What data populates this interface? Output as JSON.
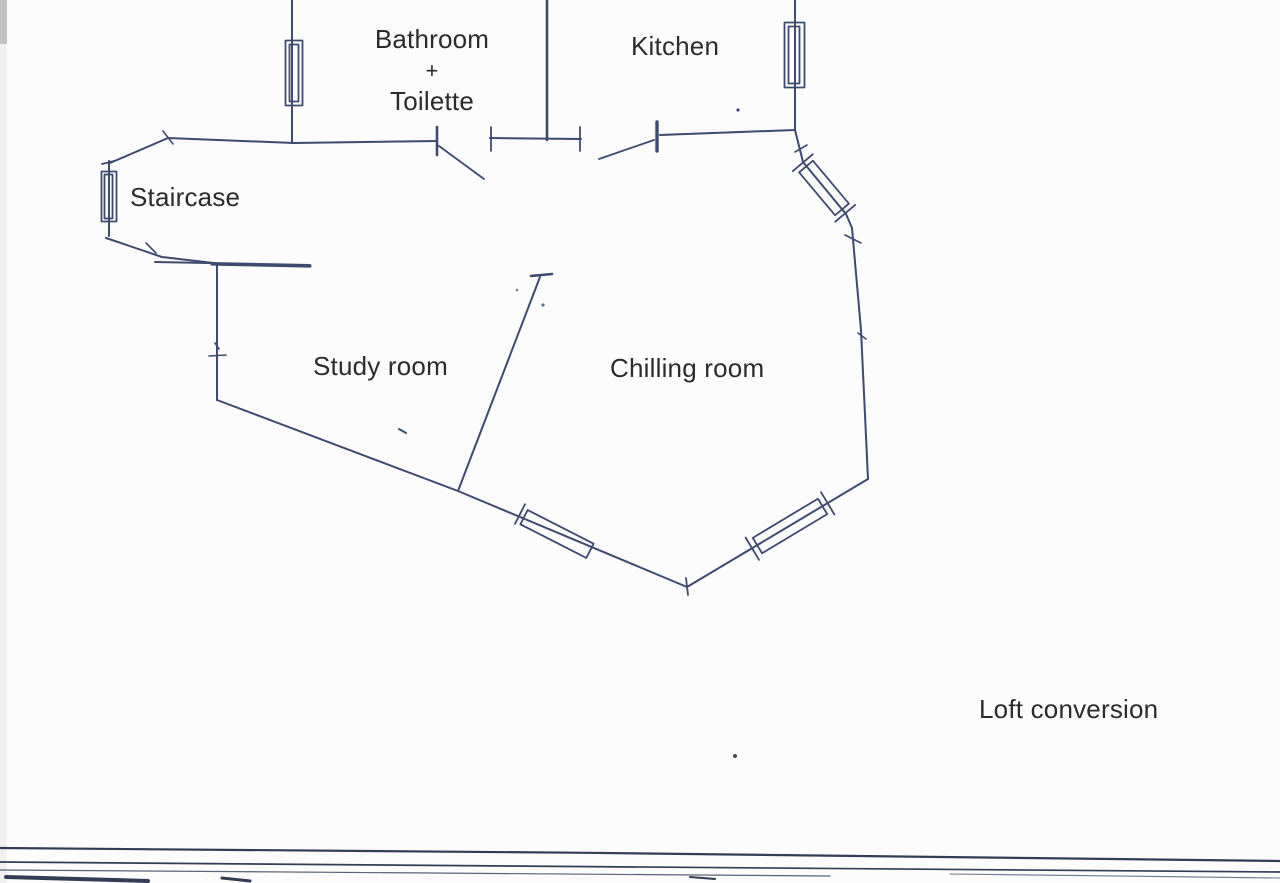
{
  "document": {
    "kind": "scanned hand-drawn floor plan",
    "rooms": {
      "bathroom": {
        "line1": "Bathroom",
        "line2": "+",
        "line3": "Toilette"
      },
      "kitchen": "Kitchen",
      "staircase": "Staircase",
      "study": "Study room",
      "chilling": "Chilling room"
    },
    "annotation": {
      "loft": "Loft conversion"
    },
    "colors": {
      "ink": "#3e4a6e",
      "label_text": "#2b2b2b",
      "paper": "#fcfcfc",
      "scan_line": "#323c54",
      "scan_corner": "#c2c2c2"
    }
  }
}
